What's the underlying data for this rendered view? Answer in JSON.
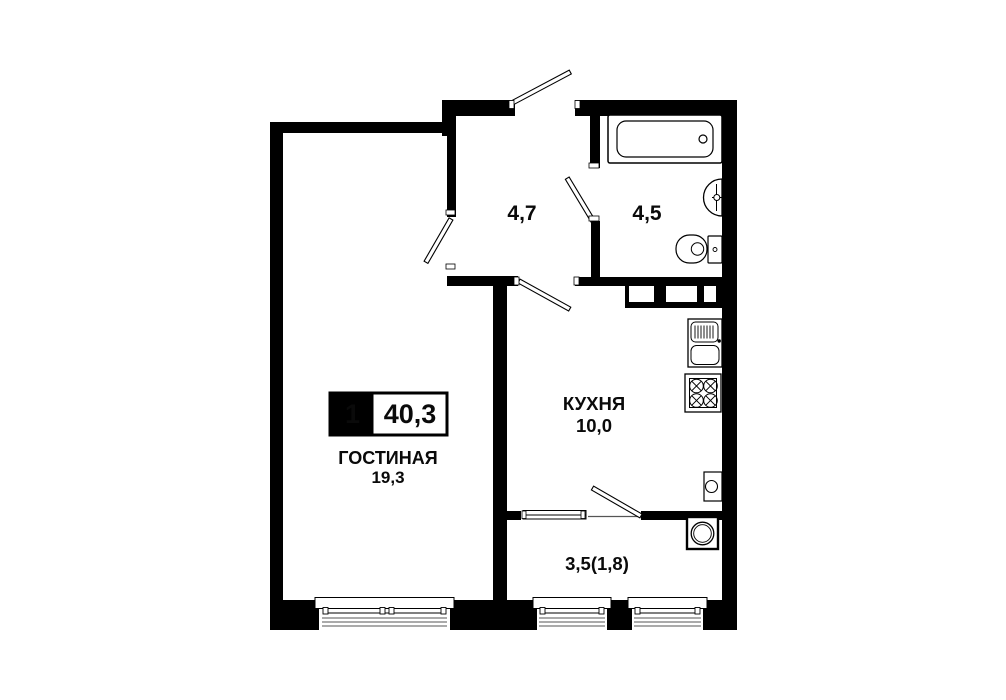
{
  "plan": {
    "badge": {
      "rooms_count": "1",
      "total_area": "40,3"
    },
    "living": {
      "name": "ГОСТИНАЯ",
      "area": "19,3"
    },
    "hall": {
      "area": "4,7"
    },
    "bathroom": {
      "area": "4,5"
    },
    "kitchen": {
      "name": "КУХНЯ",
      "area": "10,0"
    },
    "balcony": {
      "area": "3,5(1,8)"
    },
    "colors": {
      "wall": "#000000",
      "background": "#ffffff",
      "window_line": "#8e8e8e"
    },
    "fixtures": [
      "bathtub",
      "bathroom-sink",
      "toilet",
      "vent-shaft",
      "kitchen-sink",
      "stove",
      "water-heater",
      "ac-unit"
    ]
  }
}
